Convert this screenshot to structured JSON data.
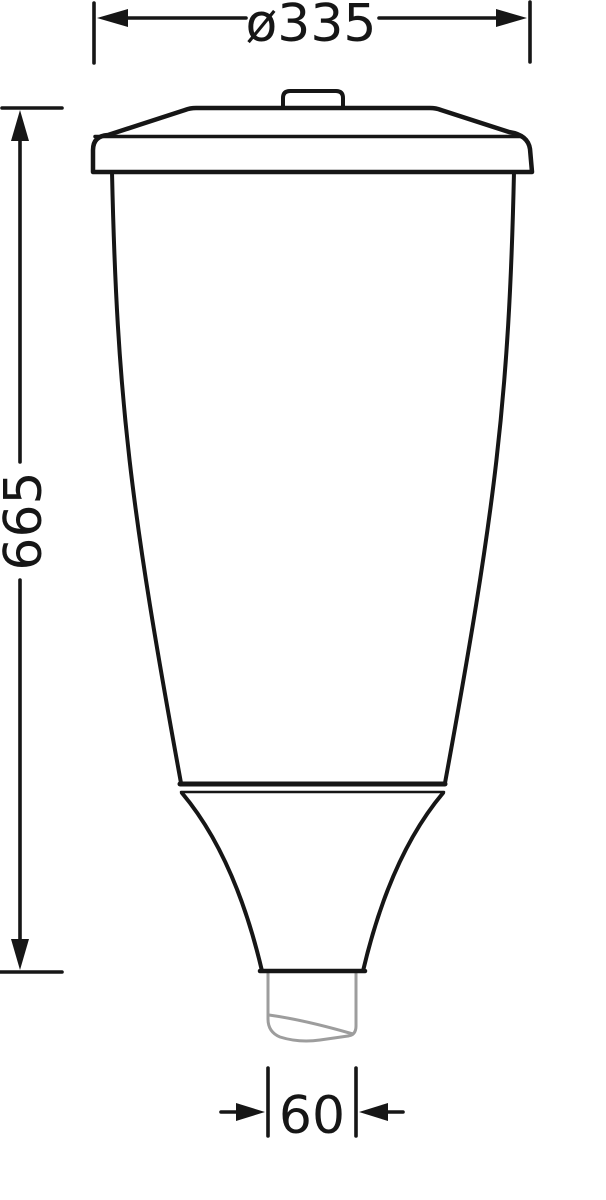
{
  "drawing": {
    "labels": {
      "diameter_top": "ø335",
      "height": "665",
      "spigot_width": "60"
    },
    "colors": {
      "outline": "#161616",
      "dimension": "#161616",
      "spigot": "#9d9d9d",
      "background": "#ffffff"
    }
  }
}
